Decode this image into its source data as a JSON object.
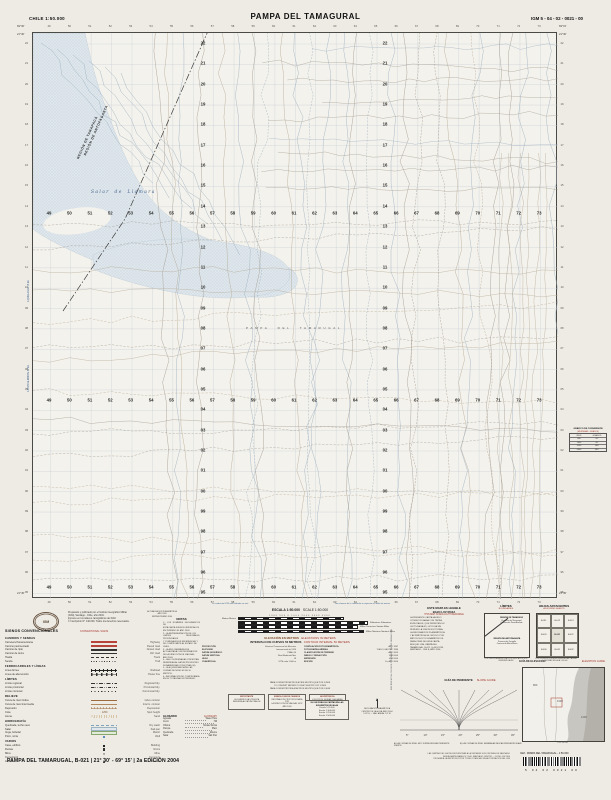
{
  "header": {
    "country_scale": "CHILE  1:50.000",
    "title": "PAMPA DEL TAMAGURAL",
    "sheet_code": "IGM 5 - 04 - 02 - 0021 - 00"
  },
  "map": {
    "easting_labels": [
      "49",
      "50",
      "51",
      "52",
      "53",
      "54",
      "55",
      "56",
      "57",
      "58",
      "59",
      "60",
      "61",
      "62",
      "63",
      "64",
      "65",
      "66",
      "67",
      "68",
      "69",
      "70",
      "71",
      "72",
      "73"
    ],
    "northing_labels": [
      "22",
      "21",
      "20",
      "19",
      "18",
      "17",
      "16",
      "15",
      "14",
      "13",
      "12",
      "11",
      "10",
      "09",
      "08",
      "07",
      "06",
      "05",
      "04",
      "03",
      "02",
      "01",
      "00",
      "99",
      "98",
      "97",
      "96",
      "95"
    ],
    "corners": {
      "top_left_lon": "69°30'",
      "top_right_lon": "69°15'",
      "top_lat": "21°30'",
      "bottom_lat": "21°45'"
    },
    "labels": {
      "salar": "Salar de Llamara",
      "pampa": "PAMPA DEL TAMARUGAL",
      "region_north": "REGIÓN DE TARAPACÁ",
      "region_south": "REGIÓN DE ANTOFAGASTA",
      "edge_note_1": "A QUILLAGUA 18 km",
      "edge_note_2": "A POZO ALMONTE 42 km"
    },
    "colors": {
      "salar_fill": "#dfe7ec",
      "salar_dot": "#b3c5d1",
      "grid": "#c6d0d8",
      "contour": "#b7ac9a",
      "track": "#a39e94",
      "stream": "#9fb3c2",
      "boundary": "#3c3c3c"
    }
  },
  "publication": {
    "lines": [
      "Preparado y publicado por el Instituto Geográfico Militar",
      "(IGM), Santiago - Chile, año 2004.",
      "Impreso en los talleres cartográficos del IGM.",
      "© Inscripción N° 140.000. Todos los derechos reservados."
    ]
  },
  "update_block": {
    "lines": [
      "ACTUALIZACIÓN PLANIMÉTRICA",
      "AÑO 2003",
      "IMPRESIÓN AÑO 2004"
    ]
  },
  "legend": {
    "title": "SIGNOS CONVENCIONALES",
    "title_en": "CONVENTIONAL SIGNS",
    "rows": [
      {
        "sub": "CAMINOS Y SENDAS"
      },
      {
        "es": "Carretera Panamericana",
        "en": "Highway",
        "sym": "hw"
      },
      {
        "es": "Camino pavimentado",
        "en": "Paved road",
        "sym": "paved"
      },
      {
        "es": "Camino de ripio",
        "en": "Gravel road",
        "sym": "gravel"
      },
      {
        "es": "Camino de tierra",
        "en": "Dirt road",
        "sym": "dirt"
      },
      {
        "es": "Huella",
        "en": "Track",
        "sym": "dash"
      },
      {
        "es": "Senda",
        "en": "Trail",
        "sym": "dots"
      },
      {
        "sub": "FERROCARRILES Y LÍNEAS"
      },
      {
        "es": "Línea férrea",
        "en": "Railroad",
        "sym": "rail"
      },
      {
        "es": "Línea de alta tensión",
        "en": "Power line",
        "sym": "power"
      },
      {
        "sub": "LÍMITES"
      },
      {
        "es": "Límite regional",
        "en": "Regional bdy.",
        "sym": "dashdot"
      },
      {
        "es": "Límite provincial",
        "en": "Provincial bdy.",
        "sym": "dashdd"
      },
      {
        "es": "Límite comunal",
        "en": "Communal bdy.",
        "sym": "dotline"
      },
      {
        "sub": "RELIEVE"
      },
      {
        "es": "Curva de nivel índice",
        "en": "Index contour",
        "sym": "contour"
      },
      {
        "es": "Curva de nivel intermedia",
        "en": "Interm. contour",
        "sym": "contour2"
      },
      {
        "es": "Depresión",
        "en": "Depression",
        "sym": "depr"
      },
      {
        "es": "Cota",
        "en": "Spot height",
        "sym": "spot",
        "symtext": "∙ 1250"
      },
      {
        "es": "Arena",
        "en": "Sand",
        "sym": "sand"
      },
      {
        "sub": "HIDROGRAFÍA"
      },
      {
        "es": "Quebrada, lecho seco",
        "en": "Dry wash",
        "sym": "wash"
      },
      {
        "es": "Salar",
        "en": "Salt pan",
        "sym": "salar"
      },
      {
        "es": "Vega, bofedal",
        "en": "Marsh",
        "sym": "vega"
      },
      {
        "es": "Pozo, noria",
        "en": "Well",
        "sym": "well"
      },
      {
        "sub": "VARIOS"
      },
      {
        "es": "Casa, edificio",
        "en": "Building",
        "sym": "bld"
      },
      {
        "es": "Ruinas",
        "en": "Ruins",
        "sym": "ruin"
      },
      {
        "es": "Mina",
        "en": "Mine",
        "sym": "mine",
        "symtext": "✕"
      },
      {
        "es": "Cementerio",
        "en": "Cemetery",
        "sym": "cem",
        "symtext": "+"
      },
      {
        "es": "Antena",
        "en": "Antenna",
        "sym": "ant"
      }
    ]
  },
  "notas": {
    "title": "NOTAS",
    "lines": [
      "1.- LOS NOMBRES GEOGRÁFICOS DE",
      "ESTA CARTA FUERON VERIFICADOS",
      "EN TERRENO EL AÑO 2003.",
      "2.- LA REPRESENTACIÓN DE LOS",
      "LÍMITES REGIONALES, PROVINCIALES",
      "Y COMUNALES ES REFERENCIAL Y",
      "NO COMPROMETE AL ESTADO DE",
      "CHILE.",
      "3.- LA RED CAMINERA FUE",
      "ACTUALIZADA CON INFORMACIÓN",
      "DE LA DIRECCIÓN DE VIALIDAD,",
      "AÑO 2003.",
      "4.- LAS COORDENADAS UTM ESTÁN",
      "REFERIDAS AL DATUM PROVISORIO",
      "SUDAMERICANO 1956 (PSAD-56).",
      "5.- LA EQUIDISTANCIA DE LAS",
      "CURVAS DE NIVEL ES DE 50",
      "METROS.",
      "6.- INFORMACIÓN NO COMPROBADA",
      "EN SU TOTALIDAD EN TERRENO."
    ]
  },
  "scale": {
    "es": "ESCALA 1:50.000",
    "en": "SCALE 1:50.000",
    "note_left": "La cuadrícula UTM está indicada en azul",
    "note_right": "Los números de la cuadrícula se expresan en miles de metros",
    "numbers": "1000  500  0  1000  2000  3000  4000",
    "bars": [
      {
        "es": "Metros",
        "en": "Meters",
        "side": "left",
        "w": 104
      },
      {
        "es": "Kilómetros",
        "en": "Kilometers",
        "side": "right",
        "w": 128
      },
      {
        "es": "Millas Terrestres",
        "en": "Statute Miles",
        "side": "right",
        "w": 118
      },
      {
        "es": "Millas Náuticas",
        "en": "Nautical Miles",
        "side": "right",
        "w": 124
      }
    ]
  },
  "elevation": {
    "es": "ELEVACIÓN EN METROS",
    "en": "ELEVATIONS IN METERS",
    "interval_es": "INTERVALO DE CURVAS 50 METROS",
    "interval_en": "CONTOUR INTERVAL 50 METERS",
    "left_pairs": [
      [
        "PROYECCIÓN",
        "Universal Transversal de Mercator"
      ],
      [
        "ELIPSOIDE",
        "Internacional de 1924"
      ],
      [
        "DATUM GEODÉSICO",
        "PSAD-56"
      ],
      [
        "DATUM VERTICAL",
        "Nivel Medio del Mar"
      ],
      [
        "HUSO",
        "19"
      ],
      [
        "CUADRÍCULA",
        "UTM cada 1.000 m"
      ]
    ],
    "right_pairs": [
      [
        "COMPILACIÓN FOTOGRAMÉTRICA",
        "AÑO 1997"
      ],
      [
        "FOTOGRAFÍAS AÉREAS",
        "VUELO GEOTEC 1996"
      ],
      [
        "CLASIFICACIÓN DE TERRENO",
        "AÑO 2003"
      ],
      [
        "DIBUJO Y REDACCIÓN",
        "IGM 2004"
      ],
      [
        "IMPRESIÓN",
        "IGM 2004"
      ],
      [
        "EDICIÓN",
        "2a, AÑO 2004"
      ]
    ],
    "conversion_lines": [
      "PARA CONVERTIR METROS A PIES MULTIPLIQUE POR 3,2808",
      "TO CONVERT METERS TO FEET MULTIPLY BY 3.2808",
      "PARA CONVERTIR PIES A METROS MULTIPLIQUE POR 0,3048"
    ]
  },
  "info_boxes": [
    {
      "title": "IMPORTANTE",
      "lines": [
        "LA CUADRÍCULA UTM ESTÁ",
        "REFERIDA AL DATUM PSAD-56"
      ]
    },
    {
      "title": "SIMBOLOGÍA DE CAMINOS",
      "lines": [
        "INFORMACIÓN PROPORCIONADA POR",
        "LA DIRECCIÓN DE VIALIDAD, MOP",
        "AÑO 2003"
      ]
    },
    {
      "title": "ADVERTENCIA",
      "lines": [
        "LOS POZOS, NORIAS Y AGUADAS",
        "SON REFERENCIALES Y PUEDEN",
        "VARIAR EN EL TIEMPO"
      ]
    }
  ],
  "scales_box": {
    "title": "EL IGM PUBLICA CARTAS EN LAS SIGUIENTES ESCALAS",
    "items": [
      "Escala  1:25.000",
      "Escala  1:100.000",
      "Escala  1:250.000",
      "Escala  1:500.000"
    ]
  },
  "declination": {
    "lines": [
      "DECLINACIÓN MAGNÉTICA",
      "CENTRO DE LA HOJA, AÑO 2004",
      "1°42' E — VAR. ANUAL 7,8' W"
    ]
  },
  "vertical_ref": "REFERENCIA CRONOLÓGICA DE LA INFORMACIÓN",
  "glossary": {
    "title_es": "GLOSARIO",
    "title_en": "GLOSSARY",
    "entries": [
      [
        "Aguada",
        "Water Hole"
      ],
      [
        "Cerro",
        "Hill"
      ],
      [
        "Oficina",
        "Nitrate Works"
      ],
      [
        "Pampa",
        "Plain"
      ],
      [
        "Quebrada",
        "Ravine"
      ],
      [
        "Salar",
        "Salt Pan"
      ]
    ]
  },
  "red_light": {
    "es1": "ESTE MAPA ES LEGIBLE",
    "es2": "BAJO LUZ ROJA",
    "en": "THIS MAP IS RED-LIGHT READABLE",
    "lines": [
      "LA PRESENTE CARTA HA SIDO",
      "CONFECCIONADA CON TINTAS",
      "ESPECIALES, QUE PERMITEN SU",
      "LECTURA BAJO LUZ ROJA SIN",
      "PERDER LA VISIÓN NOCTURNA.",
      "LA INFORMACIÓN PLANIMÉTRICA",
      "Y ALTIMÉTRICA SE OBTUVO POR",
      "MÉTODOS FOTOGRAMÉTRICOS.",
      "PARA CITAS DE ESTA CARTA",
      "INDIQUE: IGM, PAMPA DEL",
      "TAMARUGAL, B-021, 2a EDICIÓN,",
      "SANTIAGO - CHILE, AÑO 2004."
    ]
  },
  "slope_guide": {
    "title_es": "GUÍA DE PENDIENTE",
    "title_en": "SLOPE GUIDE",
    "axis_labels": [
      "5°",
      "10°",
      "15°",
      "20°",
      "25°",
      "30°",
      "45°"
    ],
    "caption_a": "A) LAS CURVAS DE NIVEL MUY JUNTAS INDICAN PENDIENTE FUERTE",
    "caption_b": "B) LAS CURVAS DE NIVEL SEPARADAS INDICAN PENDIENTE SUAVE"
  },
  "limits": {
    "title_es": "LÍMITES",
    "title_en": "BOUNDARIES",
    "upper": [
      "REGIÓN DE TARAPACÁ",
      "Provincia del Tamarugal",
      "Comuna de Pozo Almonte"
    ],
    "lower": [
      "REGIÓN DE ANTOFAGASTA",
      "Provincia de Tocopilla",
      "Comuna de María Elena"
    ],
    "caption": "LOS LÍMITES ADMINISTRATIVOS INDICADOS SON REFERENCIALES"
  },
  "adjoining": {
    "title_es": "HOJAS ADYACENTES",
    "title_en": "ADJOINING SHEETS",
    "cells": [
      "B-011",
      "B-012",
      "B-013",
      "B-020",
      "B-021",
      "B-022",
      "B-030",
      "B-031",
      "B-032"
    ],
    "caption": "LOS CÓDIGOS CORRESPONDEN A LAS CARTAS VECINAS ESCALA 1:50.000"
  },
  "elevation_guide": {
    "title_es": "GUÍA DE ELEVACIÓN",
    "title_en": "ELEVATION GUIDE",
    "labels": [
      "800",
      "1000",
      "1200"
    ],
    "scale_label": "0        10        20 KM"
  },
  "conversion_chart": {
    "title": "GRÁFICO DE CONVERSIÓN",
    "subtitle": "(MILÉSIMAS - GRADOS)",
    "rows": [
      [
        "MILS",
        "GRADOS"
      ],
      [
        "800",
        "45°"
      ],
      [
        "1600",
        "90°"
      ],
      [
        "3200",
        "180°"
      ],
      [
        "6400",
        "360°"
      ]
    ]
  },
  "barcode": {
    "label": "IGM - PAMPA DEL TAMARUGAL - 1:50.000",
    "digits": "5  04  02  0021  00"
  },
  "footer": {
    "left": "PAMPA DEL TAMARUGAL, B-021  |  21° 30' - 69° 15'  |  2a EDICIÓN 2004",
    "right_lines": [
      "LAS CARTAS DEL IGM SE ENCUENTRAN A LA VENTA EN SUS OFICINAS DE SANTIAGO",
      "NUEVA SANTA ISABEL N° 1640, SANTIAGO CENTRO — FONO 410 9300",
      "PROHIBIDA LA REPRODUCCIÓN TOTAL O PARCIAL SIN AUTORIZACIÓN DEL IGM"
    ]
  }
}
